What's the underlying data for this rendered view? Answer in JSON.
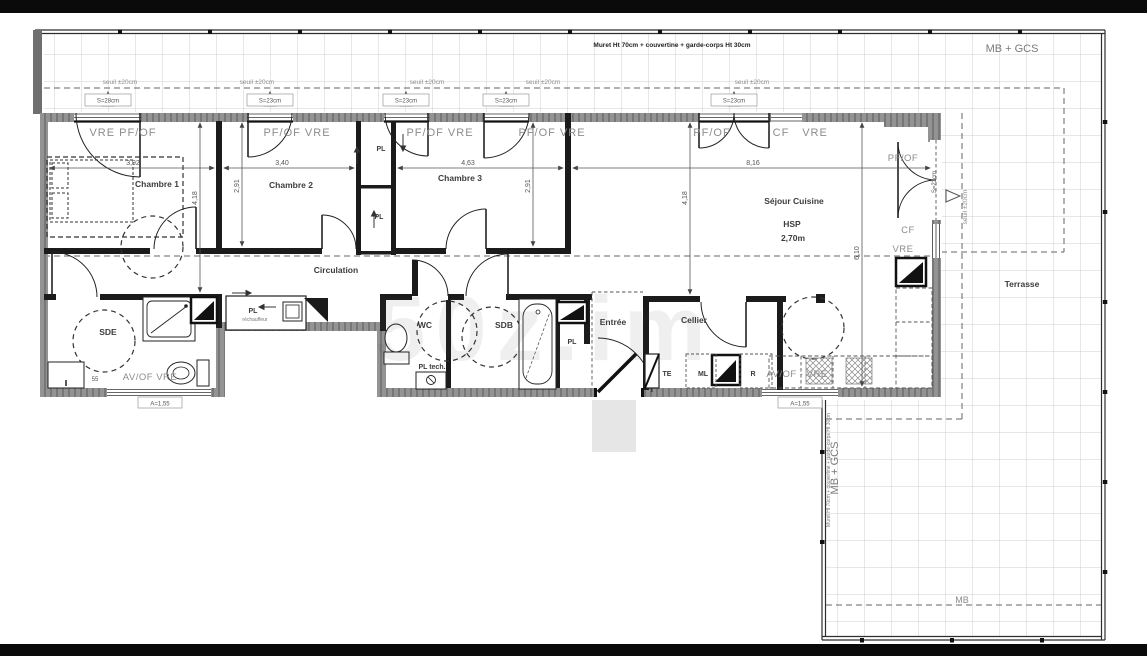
{
  "meta": {
    "watermark": "50z.im"
  },
  "notes": {
    "muret_top": "Muret Ht 70cm + couvertine + garde-corps Ht 30cm",
    "muret_side": "Muret Ht 70cm + couvertine + garde-corps Ht 30cm",
    "mb_gcs": "MB + GCS",
    "mb_gcs_side": "MB + GCS",
    "mb": "MB",
    "seuil": "seuil ±20cm"
  },
  "rooms": {
    "chambre1": "Chambre 1",
    "chambre2": "Chambre 2",
    "chambre3": "Chambre 3",
    "circulation": "Circulation",
    "sde": "SDE",
    "wc": "WC",
    "sdb": "SDB",
    "entree": "Entrée",
    "cellier": "Cellier",
    "sejour": "Séjour Cuisine",
    "hsp": "HSP",
    "hsp_value": "2,70m",
    "terrasse": "Terrasse"
  },
  "openings": {
    "vre_pfof": "VRE  PF/OF",
    "pfof_vre": "PF/OF  VRE",
    "pfof": "PF/OF",
    "cf": "CF",
    "vre": "VRE",
    "avof_vre": "AV/OF  VRE",
    "avof_vre_dash": "AV/OF - VRE",
    "sill_28": "S=28cm",
    "sill_23": "S=23cm"
  },
  "fixtures": {
    "pl": "PL",
    "pl_tech": "PL tech.",
    "te": "TE",
    "ml": "ML",
    "r": "R",
    "rechauffeur": "réchauffeur",
    "ss": "55"
  },
  "dimensions": {
    "ch1_w": "3,92",
    "ch2_w": "3,40",
    "ch3_w": "4,63",
    "sejour_w": "8,16",
    "ch2_h": "2,91",
    "ch3_h": "2,91",
    "left_h": "4,18",
    "mid_h": "4,18",
    "sejour_h": "6,10",
    "a_left": "A=1,55",
    "a_right": "A=1,55"
  }
}
